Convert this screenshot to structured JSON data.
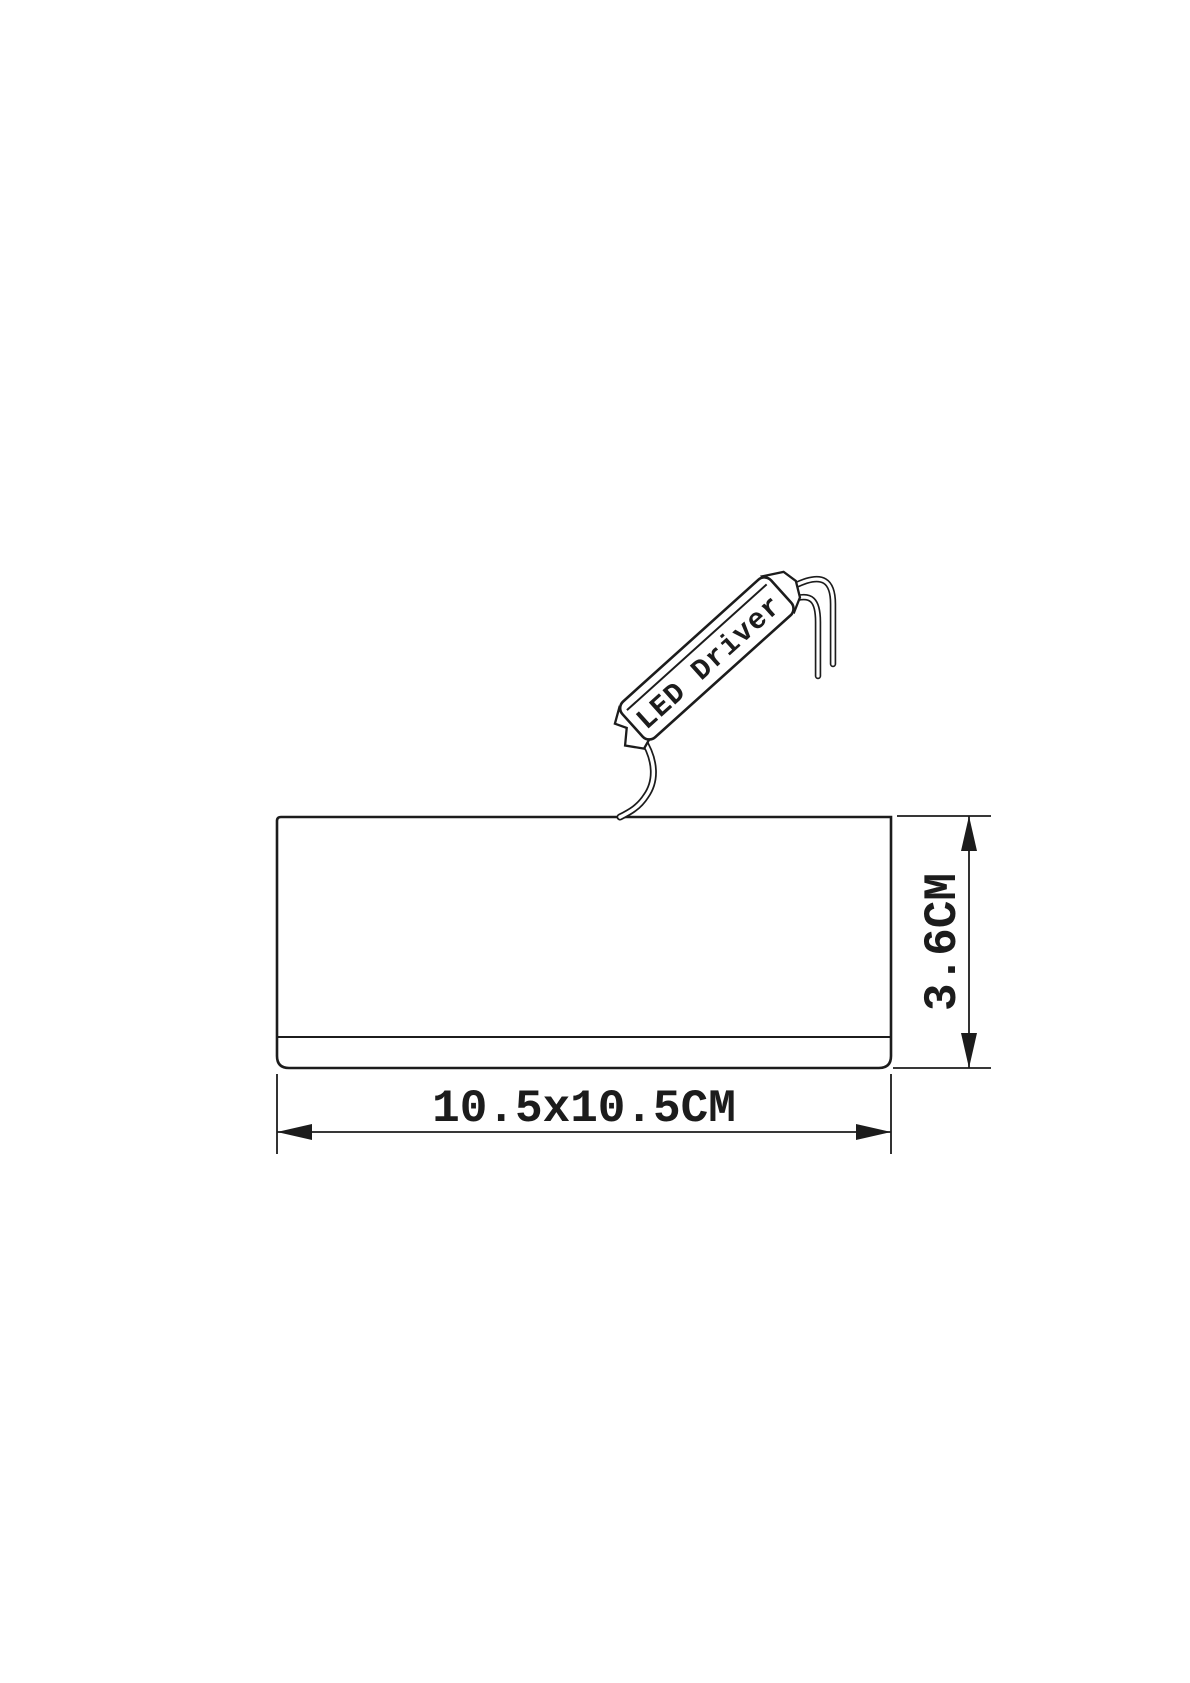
{
  "drawing": {
    "kind": "technical-dimension-drawing",
    "product": "LED ceiling light fixture side view",
    "driver_label": "LED Driver",
    "dimensions": {
      "width_label": "10.5x10.5CM",
      "height_label": "3.6CM"
    },
    "colors": {
      "line": "#1c1c1c",
      "background": "#ffffff"
    }
  }
}
